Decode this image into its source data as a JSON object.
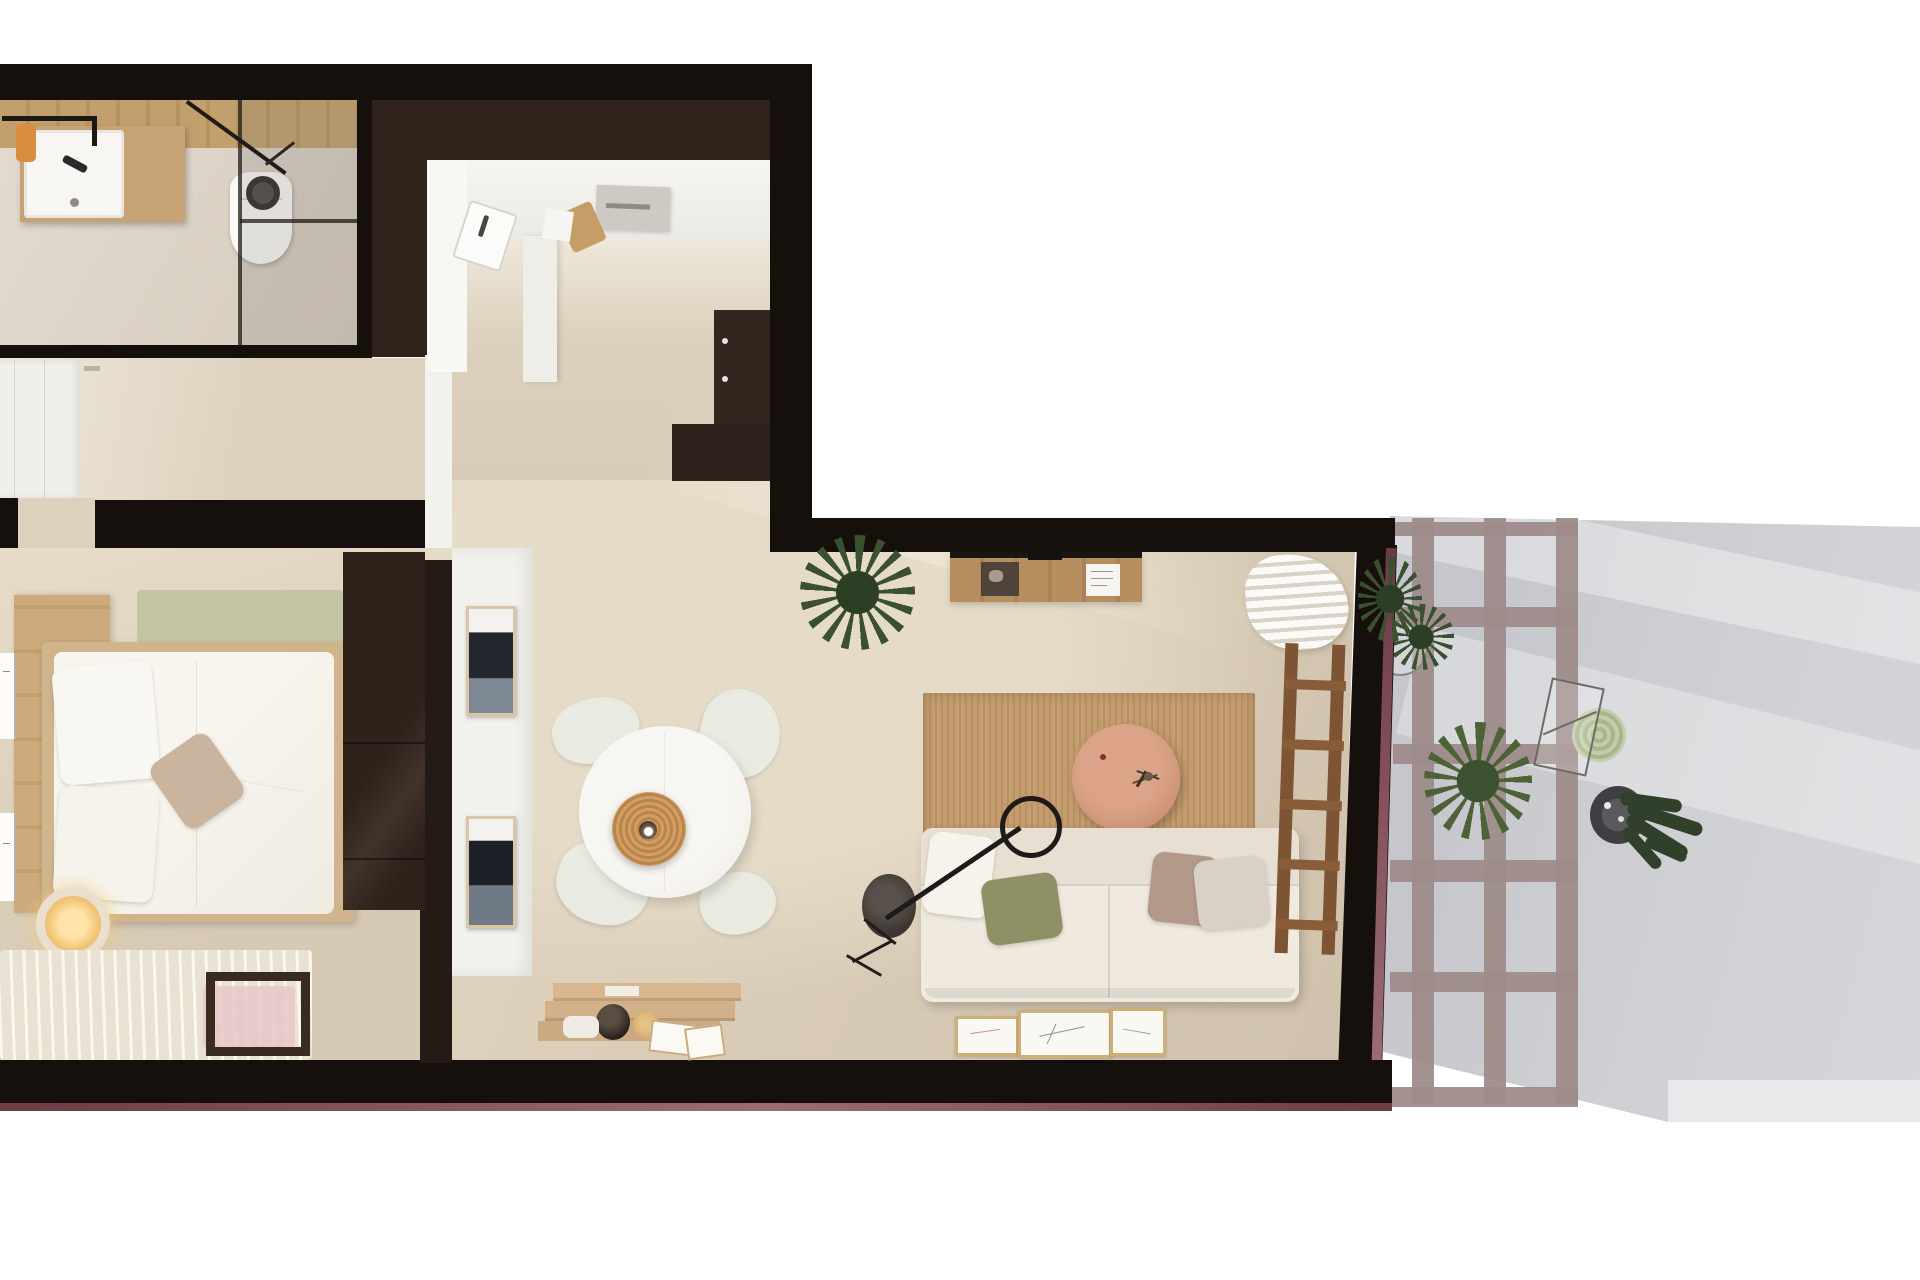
{
  "scene": {
    "title": "Top-down 3D render of a one-bedroom apartment floor plan with terrace",
    "view": "overhead dollhouse render",
    "rooms": [
      {
        "name": "bathroom",
        "position": "top-left",
        "furniture": [
          "sink-vanity-with-wood-cabinet",
          "orange-towel-on-rail",
          "toilet",
          "walk-in-glass-shower",
          "black-shower-head"
        ]
      },
      {
        "name": "kitchen",
        "position": "top-center",
        "furniture": [
          "white-counter-run",
          "inset-sink",
          "cutting-board",
          "gray-countertop-appliance",
          "dark-brown-lower-cabinets",
          "dark-brown-end-block"
        ]
      },
      {
        "name": "entry-hall",
        "position": "left-middle",
        "furniture": [
          "built-in-white-closet",
          "door-handle"
        ]
      },
      {
        "name": "bedroom",
        "position": "left-bottom",
        "furniture": [
          "wood-headboard-panel",
          "double-bed-white-duvet",
          "white-pillows",
          "taupe-accent-pillow",
          "sage-runner",
          "dark-brown-wardrobe",
          "glowing-bedside-lamp",
          "striped-cream-rug",
          "pink-rug-patch",
          "dark-wood-bench-frame",
          "leaning-art-frames"
        ]
      },
      {
        "name": "dining-area",
        "position": "center",
        "furniture": [
          "round-white-table",
          "four-white-chairs",
          "rattan-pendant-lamp",
          "two-dark-art-frames-on-wall",
          "wooden-crates-with-objects"
        ]
      },
      {
        "name": "living-room",
        "position": "center-right",
        "furniture": [
          "wall-desk-with-papers",
          "spiky-potted-plant",
          "jute-area-rug",
          "round-terracotta-coffee-table",
          "black-arc-floor-lamp",
          "white-sofa",
          "green-taupe-gray-cushions",
          "leaning-botanical-frames",
          "white-curtains",
          "wooden-ladder-shelf"
        ]
      },
      {
        "name": "terrace",
        "position": "right",
        "furniture": [
          "pergola-grid",
          "green-shrub-pots",
          "wire-ring-planter",
          "pale-succulent",
          "wireframe-outdoor-chair",
          "cactus-in-dark-pot"
        ]
      }
    ]
  },
  "colors": {
    "wall_black": "#16100c",
    "wall_brown": "#2f231c",
    "cabinet_brown": "#33261f",
    "floor_beige": "#dccfbb",
    "floor_light": "#e7dcc8",
    "floor_hall": "#e0d4c0",
    "white_surface": "#f3f1ec",
    "wood": "#c7a274",
    "wood_dark": "#3a2b20",
    "jute": "#c49c6e",
    "terrace_gray": "#cdced2",
    "terrace_light": "#e9e9eb",
    "pergola": "#9e8c8a",
    "plant_dark": "#3a5030",
    "plant_light": "#4e6238",
    "maroon": "#6d3b46",
    "sofa": "#efe9de",
    "pillow_green": "#8f9066",
    "pillow_taupe": "#b2998a",
    "pink": "#e7c6c8",
    "orange_towel": "#d98e3f",
    "pendant_wicker": "#c89a5e",
    "table_wood": "#cf9579"
  }
}
